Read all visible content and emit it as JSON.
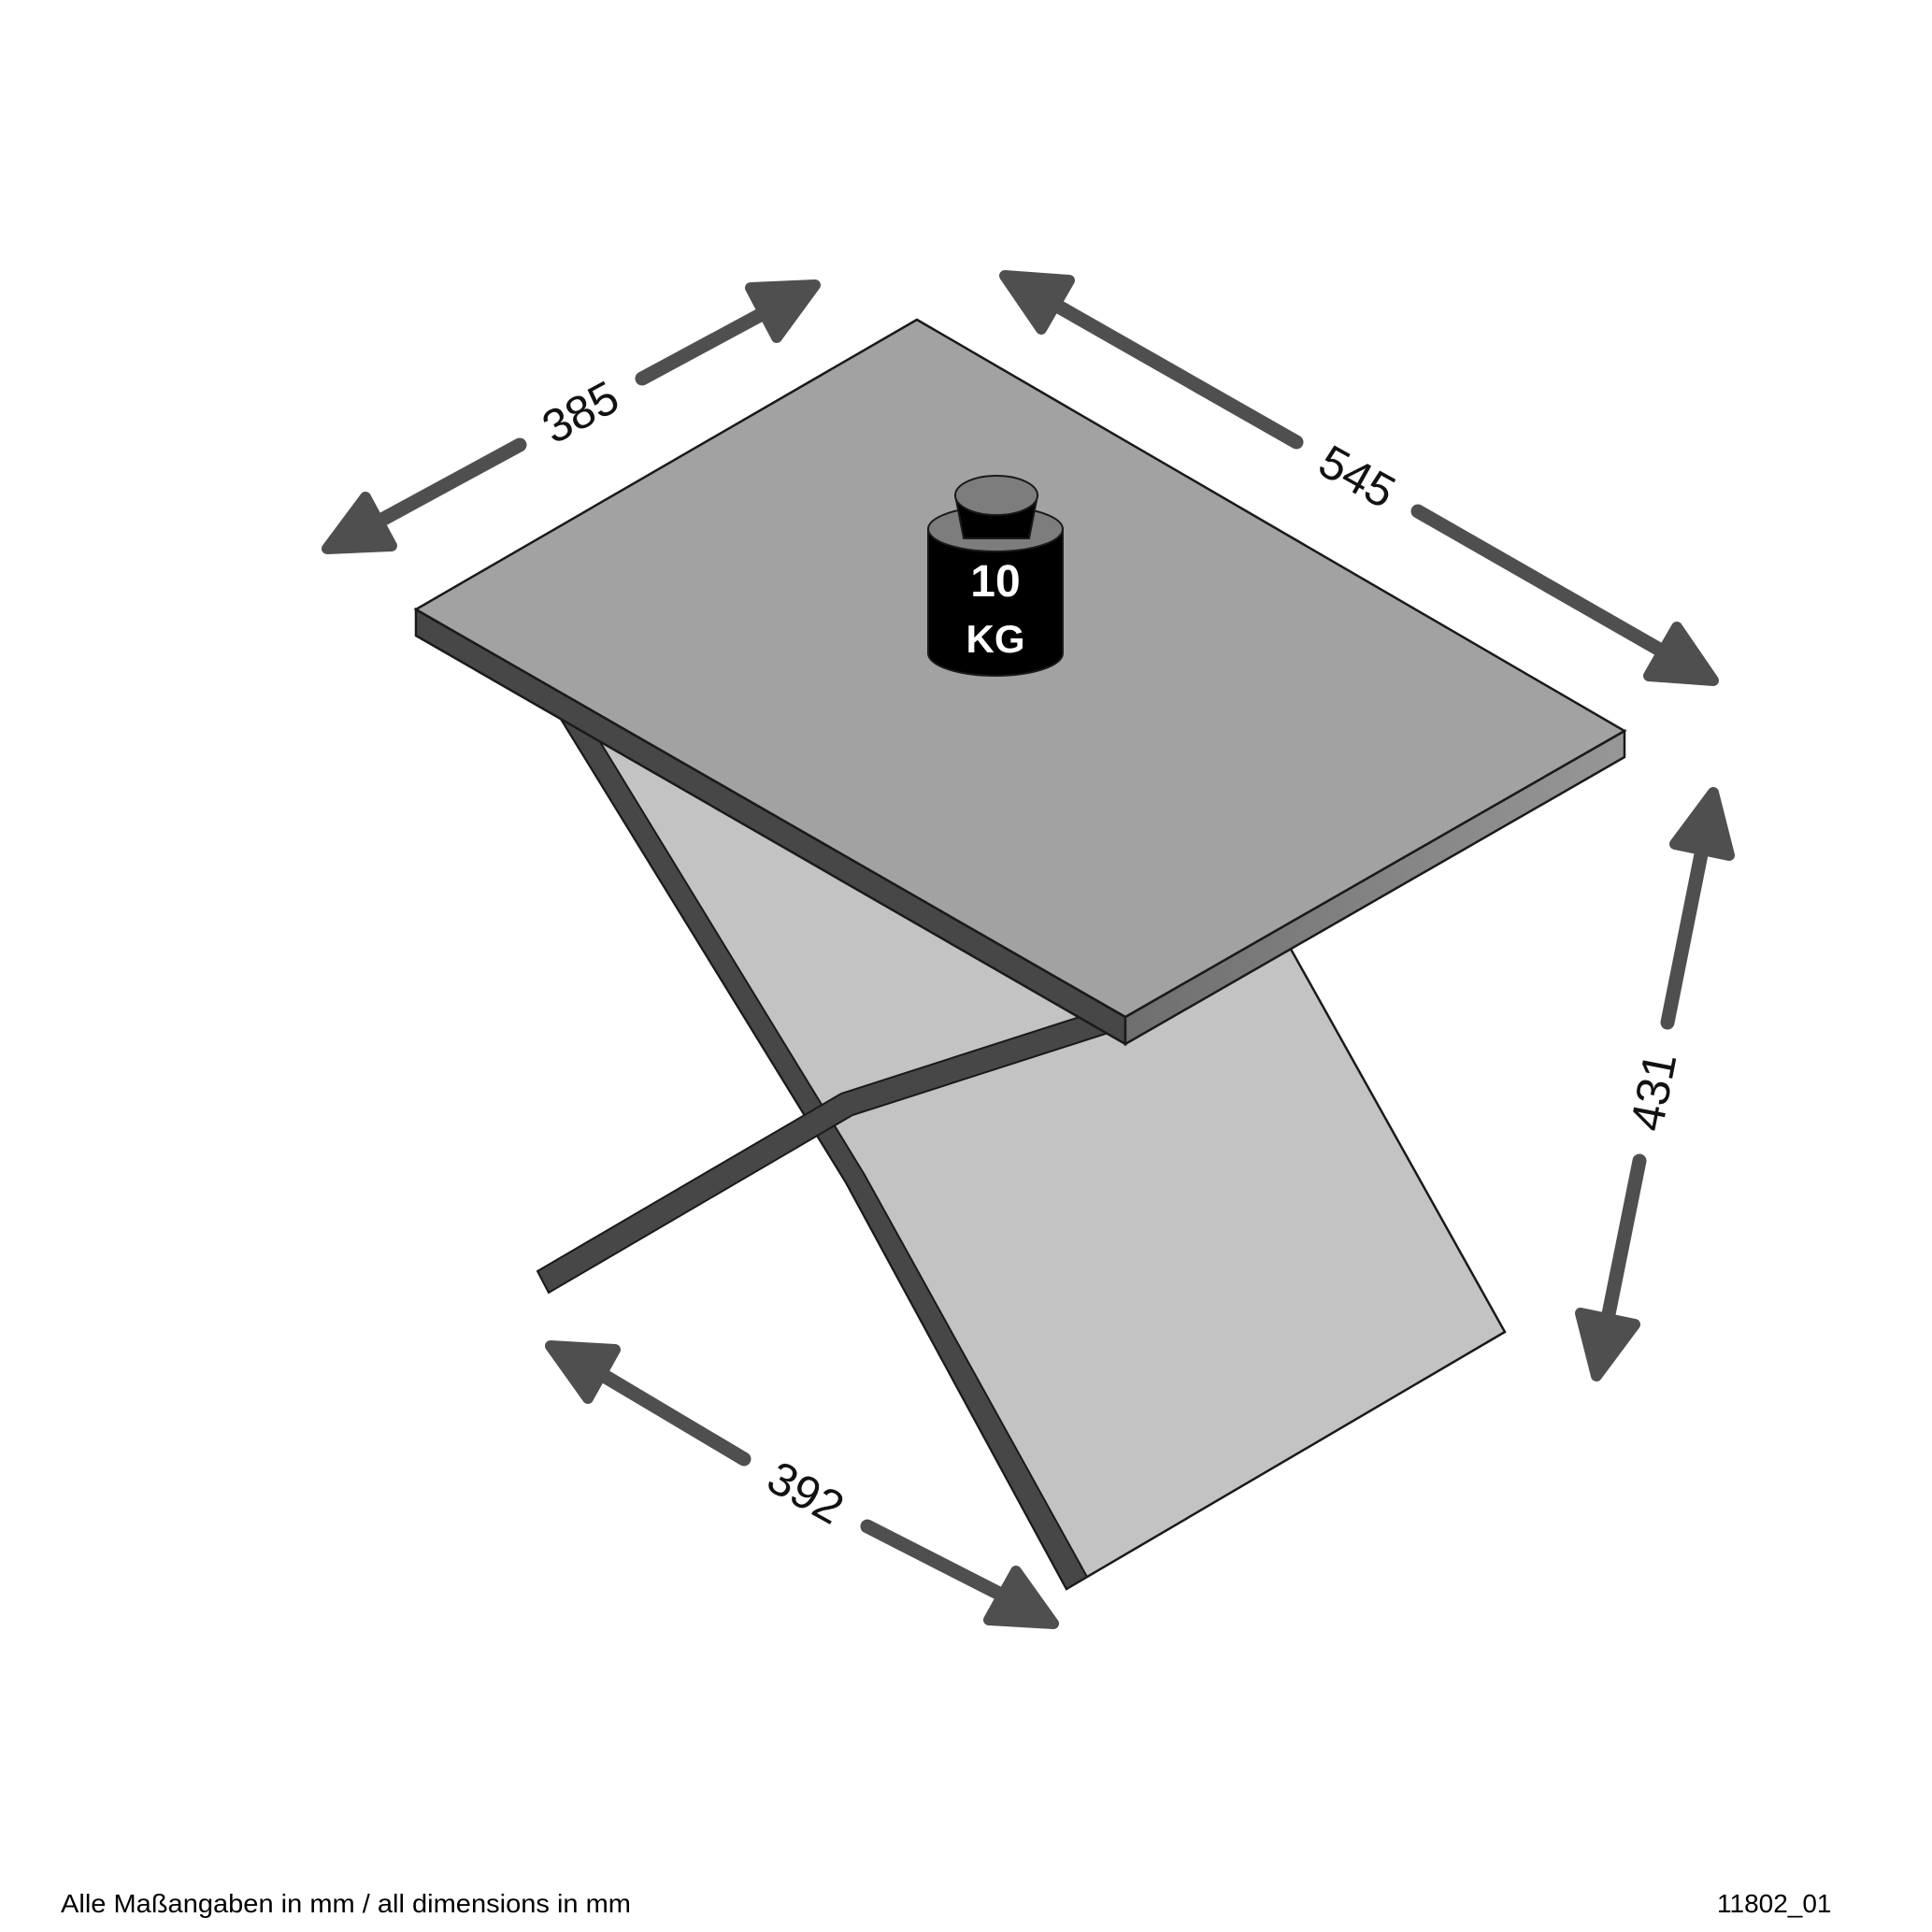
{
  "footer": {
    "note": "Alle Maßangaben in mm / all dimensions in mm",
    "drawing_number": "11802_01"
  },
  "weight_badge": {
    "value": "10",
    "unit": "KG"
  },
  "dimensions_mm": {
    "top_depth": "385",
    "top_width": "545",
    "height": "431",
    "base_depth": "392"
  },
  "colors": {
    "background": "#ffffff",
    "table_top": "#a2a2a2",
    "table_edge_dark": "#474747",
    "table_edge_light": "#8e8e8e",
    "leg_panel": "#c3c3c3",
    "panel_edge_dark": "#474747",
    "base_bar": "#474747",
    "arrow": "#4f4f4f",
    "weight_body": "#000000",
    "weight_top": "#7d7d7d",
    "text": "#121212"
  }
}
